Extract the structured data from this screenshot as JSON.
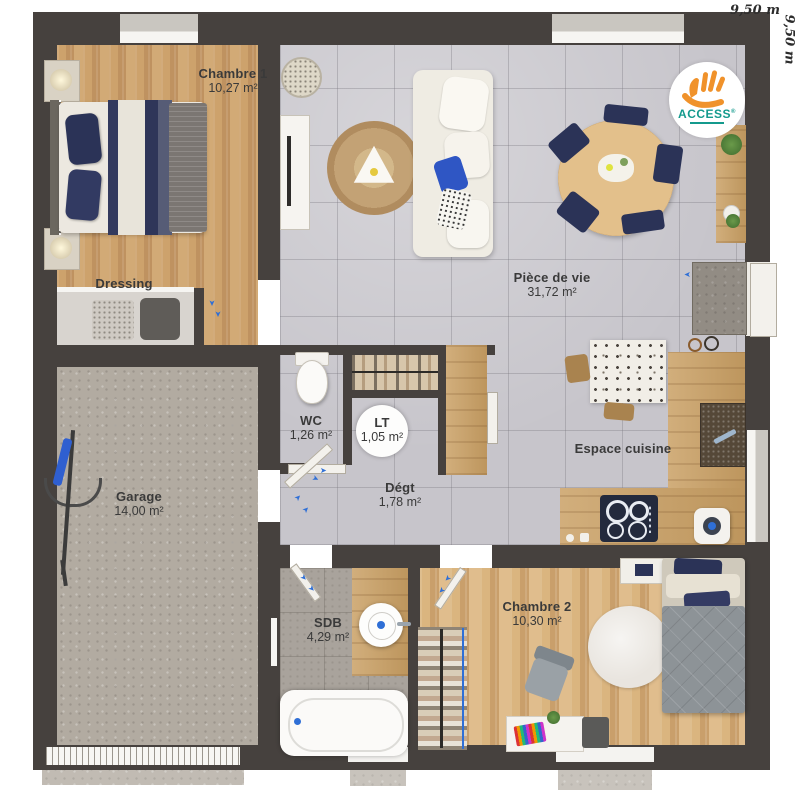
{
  "dimensions": {
    "width": "9,50 m",
    "height": "9,50 m"
  },
  "logo": {
    "brand": "ACCESS",
    "mark": "®"
  },
  "rooms": {
    "chambre1": {
      "name": "Chambre 1",
      "area": "10,27 m²"
    },
    "dressing": {
      "name": "Dressing",
      "area": ""
    },
    "piece_de_vie": {
      "name": "Pièce de vie",
      "area": "31,72 m²"
    },
    "wc": {
      "name": "WC",
      "area": "1,26 m²"
    },
    "lt": {
      "name": "LT",
      "area": "1,05 m²"
    },
    "degt": {
      "name": "Dégt",
      "area": "1,78 m²"
    },
    "garage": {
      "name": "Garage",
      "area": "14,00 m²"
    },
    "espace_cuisine": {
      "name": "Espace cuisine",
      "area": ""
    },
    "sdb": {
      "name": "SDB",
      "area": "4,29 m²"
    },
    "chambre2": {
      "name": "Chambre 2",
      "area": "10,30 m²"
    }
  },
  "icons": {
    "door_swing": "➤"
  },
  "colors": {
    "wall": "#46413e",
    "wood_warm": "#c79e69",
    "wood_pale": "#d5af7e",
    "tile_gray": "#c7c5cb",
    "concrete": "#b2aba1",
    "stone": "#a9a39c",
    "accent_blue": "#2f6fd6",
    "navy": "#2b3357",
    "logo_orange": "#f0922b",
    "logo_teal": "#149a8d"
  }
}
